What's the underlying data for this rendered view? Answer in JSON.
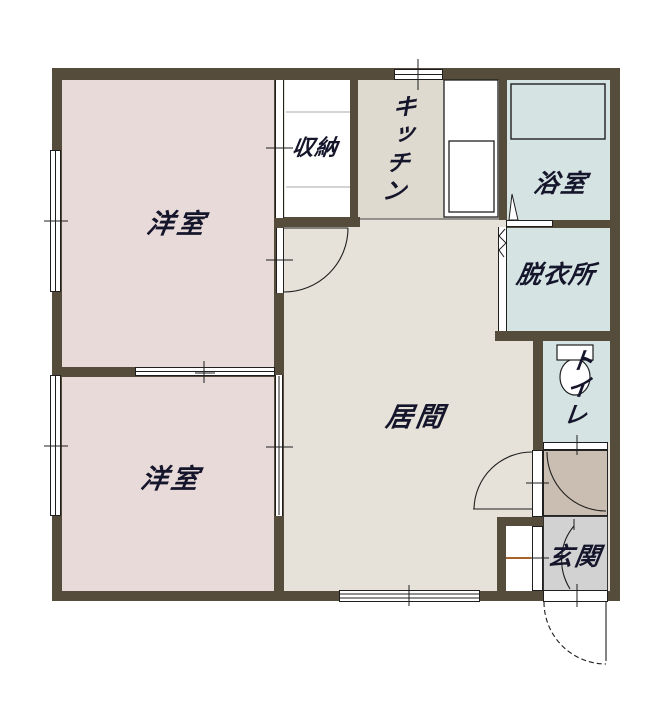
{
  "title": "間取り図",
  "colors": {
    "bg": "#ffffff",
    "wall": "#554c3b",
    "pink": "#e8dad8",
    "living": "#e6e2d9",
    "kitchen": "#dedacf",
    "wet": "#d5e3e3",
    "hall": "#c9beb1",
    "genkan": "#d2d2d2",
    "line": "#1f1f1f",
    "shelf": "#aaaaaa",
    "accent": "#a8632b",
    "text": "#15152b"
  },
  "rooms": {
    "western1": {
      "label": "洋室"
    },
    "western2": {
      "label": "洋室"
    },
    "closet": {
      "label": "収納"
    },
    "kitchen": {
      "label": "キッチン"
    },
    "bath": {
      "label": "浴室"
    },
    "dressing": {
      "label": "脱衣所"
    },
    "living": {
      "label": "居間"
    },
    "toilet": {
      "label": "トイレ"
    },
    "entrance": {
      "label": "玄関"
    }
  },
  "fixtures": {
    "bathtub": "bathtub",
    "toilet_bowl": "toilet-bowl",
    "kitchen_counter": "kitchen-counter-with-sink",
    "closet_shelves": "closet-shelf-lines",
    "entry_step": "genkan-step-line"
  }
}
